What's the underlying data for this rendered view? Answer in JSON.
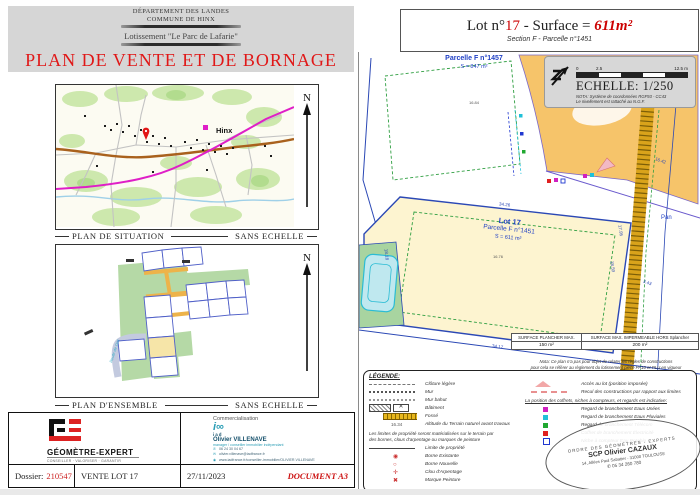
{
  "header": {
    "department": "DÉPARTEMENT DES LANDES",
    "commune": "COMMUNE DE HINX",
    "lotissement": "Lotissement  \"Le Parc de Lafarie\"",
    "title": "PLAN DE VENTE ET DE BORNAGE"
  },
  "lot_box": {
    "prefix": "Lot n°",
    "lot_number": "17",
    "middle": " - Surface = ",
    "surface": "611m²",
    "subtitle": "Section F - Parcelle n°1451"
  },
  "situation": {
    "caption": "PLAN DE SITUATION",
    "no_scale": "SANS ECHELLE",
    "town": "Hinx",
    "north": "N"
  },
  "ensemble": {
    "caption": "PLAN D'ENSEMBLE",
    "no_scale": "SANS ECHELLE",
    "north": "N",
    "road_label": "Route de Dax"
  },
  "scalebox": {
    "tick0": "0",
    "tick1": "2.5",
    "tick2": "12.5 m",
    "title": "ECHELLE: 1/250",
    "nota1": "NOTA: Système de coordonnées RGF93 - CC43",
    "nota2": "Le nivellement est rattaché au N.G.F."
  },
  "plan": {
    "parcel_top_name": "Parcelle F n°1457",
    "parcel_top_area": "S = 847 m²",
    "lot_name": "Lot 17",
    "lot_parcel": "Parcelle F n°1451",
    "lot_area": "S = 611 m²",
    "pan_label": "Pan",
    "dims": {
      "top": "34.26",
      "bottom": "34.17",
      "left": "18.18",
      "right_road": "16.42",
      "right_side": "17.95",
      "right_small": "3.43",
      "right_lower": "18.59",
      "alt_lot": "16.76",
      "alt_top": "16.84"
    }
  },
  "surface_table": {
    "h1": "SURFACE PLANCHER MAX.",
    "h2": "SURFACE MAX. IMPERMEABLE HORS Splancher",
    "v1": "150 m²",
    "v2": "200 m²",
    "nota1": "Nota: Ce plan n'a pas pour objet de relater les règles de constructions",
    "nota2": "pour cela se référer au règlement du lotissement pièce PA10 et PLU en vigueur"
  },
  "legend": {
    "title": "LÉGENDE:",
    "items_left": [
      "Clôture légère",
      "Mur",
      "Mur bahut",
      "Bâtiment",
      "Fossé",
      "Altitude du Terrain naturel avant travaux"
    ],
    "altitude_example": "16.34",
    "note1": "Les limites de propriété seront matérialisées sur le terrain par",
    "note2": "des bornes, clous d'arpentage ou marques de peinture",
    "limite": "Limite de propriété",
    "bornes": [
      "Borne Existante",
      "Borne Nouvelle",
      "Clou d'Arpentage",
      "Marque Peinture"
    ],
    "acces": "Accès au lot (position imposée)",
    "recul": "Recul des constructions par rapport aux limites",
    "indicative": "La position des coffrets, niches à compteurs, et regards est indicative:",
    "regards": [
      "Regard de branchement Eaux Usées",
      "Regard de branchement Eaux Pluviales",
      "Regard de branchement Télécom",
      "Coffret de branchement Électricité",
      "Niche à compteur Eau Potable"
    ]
  },
  "stamp": {
    "arc": "ORDRE DES GÉOMÈTRES - EXPERTS",
    "name": "SCP Olivier CAZAUX",
    "address": "14, Allées Paul Sabatier - 31000 TOULOUSE",
    "phone": "✆ 05 34 260 780"
  },
  "titleblock": {
    "brand": "GÉOMÈTRE-EXPERT",
    "tagline": "CONSEILLER · VALORISER · GARANTIR",
    "commercial_label": "Commercialisation",
    "iad_glyph": "i∞",
    "iad_word": "iad",
    "agent": "Olivier VILLENAVE",
    "agent_role": "manager / conseiller immobilier indépendant",
    "agent_phone": "06 24 30 04 67",
    "agent_email": "olivier.villenave@iadfrance.fr",
    "agent_web": "www.iadfrance.fr/conseiller-immobilier/OLIVIER.VILLENAVE",
    "dossier_label": "Dossier:",
    "dossier_value": "210547",
    "project": "VENTE LOT 17",
    "date": "27/11/2023",
    "doc_type": "DOCUMENT A3"
  }
}
